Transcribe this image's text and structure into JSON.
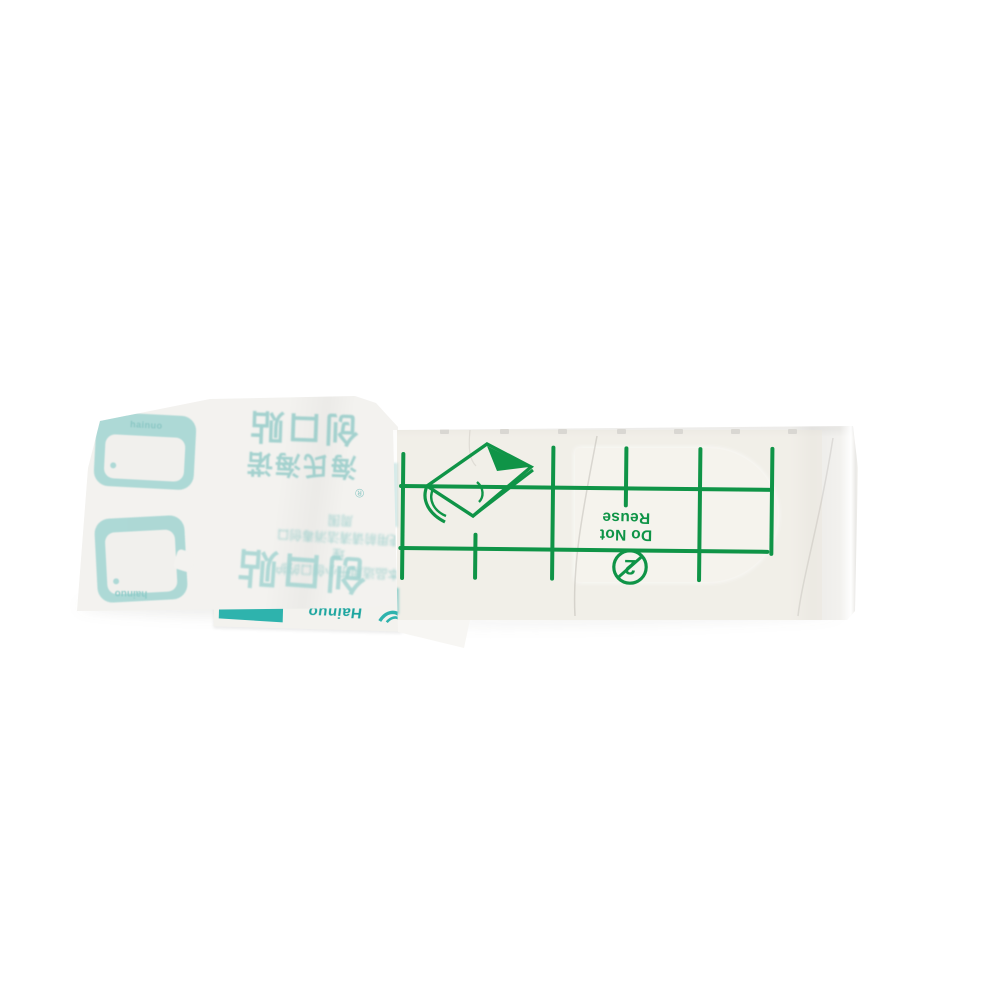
{
  "meta": {
    "description": "Product photo: transparent waterproof adhesive wound plaster with green printed grid, partially opened paper wrapper",
    "background": "#ffffff"
  },
  "colors": {
    "teal_print": "#9fd3d0",
    "teal_solid": "#2eb3ad",
    "teal_dark": "#1ba59f",
    "green": "#0f9447",
    "wrapper_paper": "#f3f2ef",
    "backing_paper": "#f7f6f3",
    "film_tint": "#ece8dd",
    "pad": "#f5f3ed"
  },
  "wrapper": {
    "product_name": "创口贴",
    "brand_name": "海氏海诺",
    "registered_mark": "®",
    "fine_print_line1": "本品适用于小创口的护理",
    "fine_print_line2": "使用前请清洁消毒创口周围",
    "product_name_repeat": "创口贴",
    "logo_label": "hainuo",
    "logo_label2": "hainuo",
    "strip_label": "Hainuo"
  },
  "bandage": {
    "warning_line1": "Do Not",
    "warning_line2": "Reuse",
    "no_reuse_digit": "2",
    "grid": {
      "color": "#0f9447",
      "thickness": 4,
      "h_lines": [
        {
          "x1": 399,
          "x2": 774,
          "y": 486
        },
        {
          "x1": 399,
          "x2": 770,
          "y": 548
        }
      ],
      "v_lines": [
        {
          "x": 403,
          "y1": 452,
          "y2": 580
        },
        {
          "x": 476,
          "y1": 532,
          "y2": 579
        },
        {
          "x": 553,
          "y1": 444,
          "y2": 579
        },
        {
          "x": 626,
          "y1": 444,
          "y2": 505
        },
        {
          "x": 700,
          "y1": 444,
          "y2": 579
        },
        {
          "x": 772,
          "y1": 443,
          "y2": 552
        }
      ]
    },
    "notches": {
      "y": 429,
      "xs": [
        440,
        500,
        558,
        617,
        674,
        731,
        788
      ]
    }
  }
}
